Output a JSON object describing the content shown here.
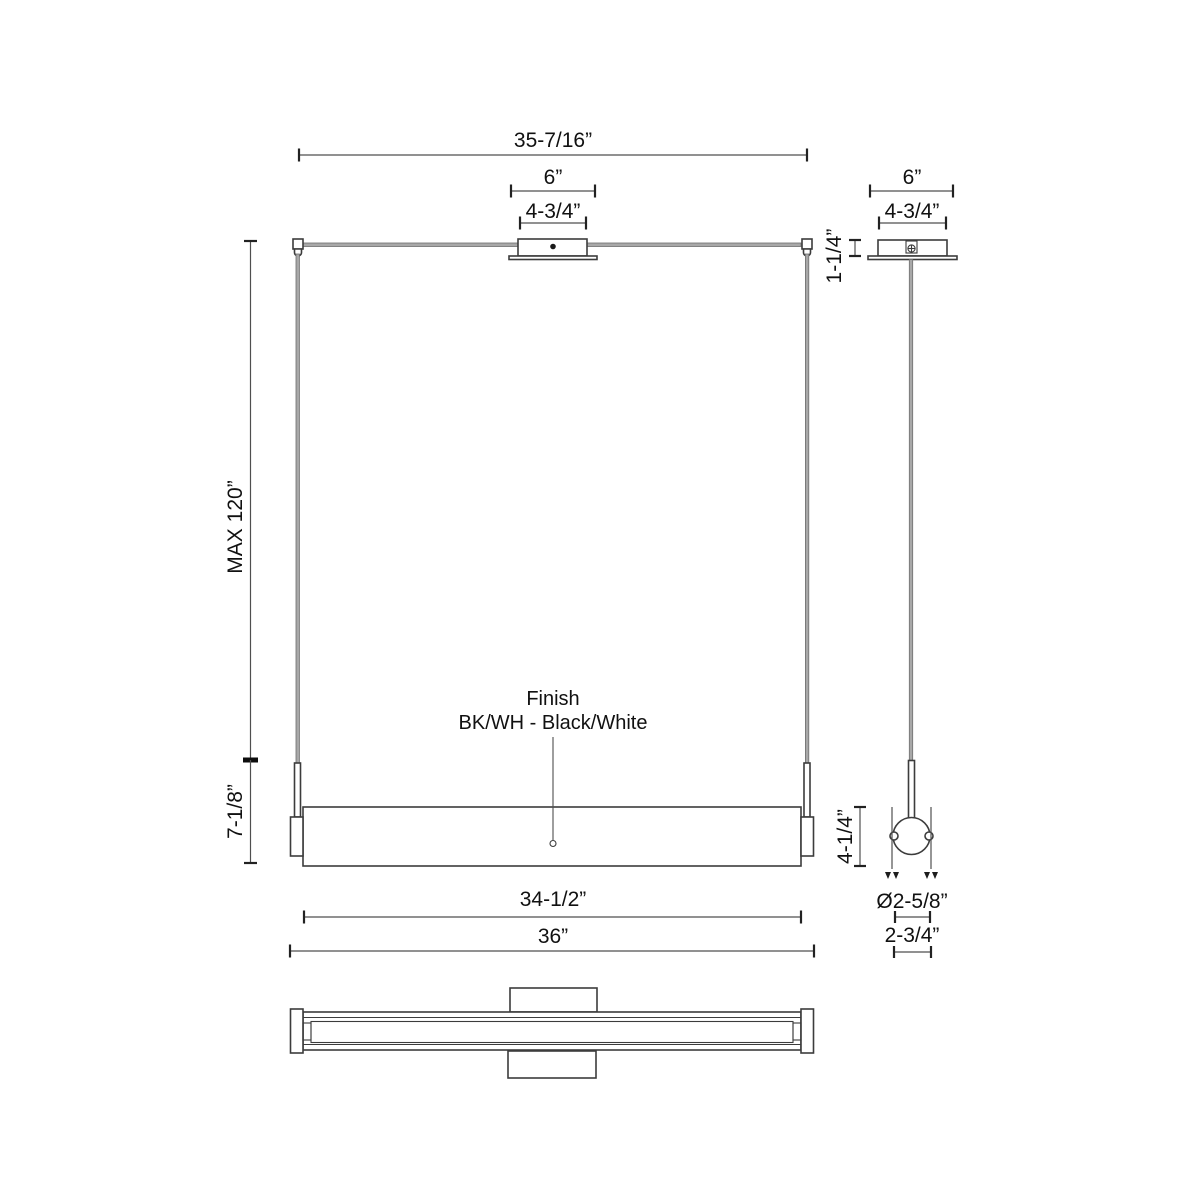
{
  "front": {
    "dim_overall_suspension": "35-7/16”",
    "dim_canopy_flange": "6”",
    "dim_canopy_body": "4-3/4”",
    "dim_max_height": "MAX 120”",
    "dim_stem_assembly": "7-1/8”",
    "dim_fixture_height": "4-1/4”",
    "dim_lens_length": "34-1/2”",
    "dim_overall_length": "36”"
  },
  "side": {
    "dim_canopy_flange": "6”",
    "dim_canopy_body": "4-3/4”",
    "dim_canopy_height": "1-1/4”",
    "dim_diameter": "Ø2-5/8”",
    "dim_body_width": "2-3/4”"
  },
  "finish": {
    "line1": "Finish",
    "line2": "BK/WH - Black/White"
  },
  "colors": {
    "outline": "#3c3c3c",
    "dim": "#4f4f4f",
    "text": "#111111",
    "cable": "#a8a8a8",
    "background": "#ffffff"
  }
}
